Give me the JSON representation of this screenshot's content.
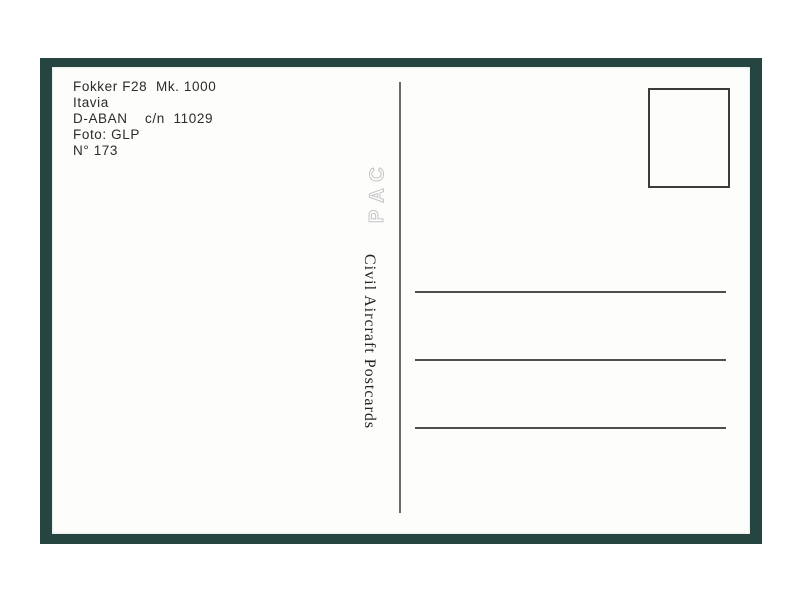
{
  "postcard": {
    "info_lines": [
      "Fokker F28  Mk. 1000",
      "Itavia",
      "D-ABAN    c/n  11029",
      "Foto: GLP",
      "N° 173"
    ],
    "monogram": [
      "C",
      "A",
      "P"
    ],
    "publisher": "Civil Aircraft Postcards",
    "address_lines": 3
  },
  "colors": {
    "mat_green": "#274540",
    "card_white": "#fdfdfb",
    "ink": "#2b2b2b",
    "rule_gray": "#4f4f4f",
    "monogram_outline": "#c4c4c4"
  }
}
